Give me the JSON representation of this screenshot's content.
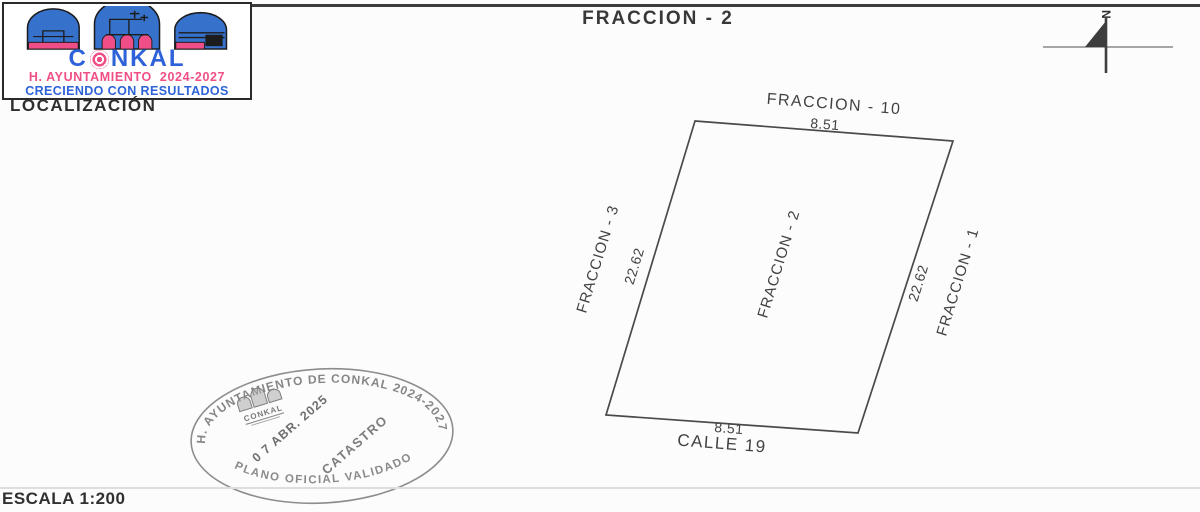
{
  "page": {
    "title": "FRACCION - 2",
    "scale_label": "ESCALA 1:200",
    "localization_label": "LOCALIZACIÓN"
  },
  "logo": {
    "name_part1": "C",
    "name_part2": "NKAL",
    "line1": "H. AYUNTAMIENTO  2024-2027",
    "line2": "CRECIENDO CON RESULTADOS",
    "colors": {
      "blue": "#2e62d9",
      "pink": "#ef4f86"
    }
  },
  "compass": {
    "north_label": "N"
  },
  "parcel": {
    "center_label": "FRACCION - 2",
    "north_neighbor": "FRACCION - 10",
    "south_street": "CALLE 19",
    "west_neighbor": "FRACCION - 3",
    "east_neighbor": "FRACCION - 1",
    "dims": {
      "top": "8.51",
      "bottom": "8.51",
      "left": "22.62",
      "right": "22.62"
    }
  },
  "stamp": {
    "arc_top": "H. AYUNTAMIENTO DE CONKAL 2024-2027",
    "arc_bottom": "PLANO OFICIAL VALIDADO",
    "emblem_text": "CONKAL",
    "date": "0 7 ABR. 2025",
    "office": "CATASTRO",
    "ink_color": "#878787"
  }
}
